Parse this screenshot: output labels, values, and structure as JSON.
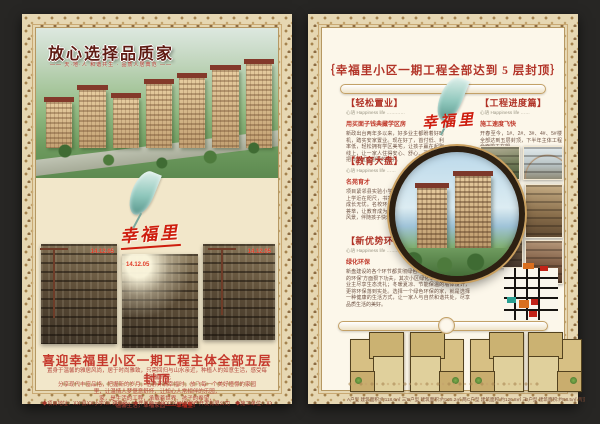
{
  "page_left": {
    "title": "放心选择品质家",
    "subtitle": "—— 天·地·人 和谐共生 · 品质人居典范 ——",
    "brand_script": "幸福里",
    "photos": [
      {
        "date": "14.12.05"
      },
      {
        "date": "14.12.05"
      },
      {
        "date": "14.12.05"
      }
    ],
    "headline": "喜迎幸福里小区一期工程主体全部五层封顶",
    "poem_lines": [
      "置身于温馨的雅居风尚，居于时尚雅致，只需回归与山水亲近，种植人的如意生活，感受每个温馨时光",
      "分享现代丰富品格，把握新的岁月，恬静开满幸福时，放飞每一个美好憧憬的家园",
      "里，让温情人梦惬意舒怀，让知心人常相伴的乐园，",
      "家，是生活的工程，承载着世界、孩子的希望，",
      "温馨生活，幸福家园"
    ],
    "poem_suffix": "——幸福里！",
    "footer": "◆项目地址：XX 县XX小学XX 路口处　◆开发商：XXXXXXX房地产开发有限公司　◆施工单位：XXXXXXXX建设有限公司"
  },
  "page_right": {
    "title": "｛幸福里小区一期工程全部达到 5 层封顶｝",
    "brand_script": "幸福里",
    "sections": [
      {
        "heading": "【轻松置业】",
        "subheading": "心语 Happiness life …………",
        "lead": "用买面子钱典藏学区房",
        "body": "新政出台两年多以来，好多业主都盼着好时机，踏实安家置业。现在好了，首付低、利率低，轻松拥有学区美宅，让孩子赢在起跑线上，让一家人住得安心、舒心、更放心，把日子过成想要的样子。"
      },
      {
        "heading": "【教育大盘】",
        "subheading": "心语 Happiness life ……",
        "lead": "名苑育才",
        "body": "项目紧邻县实验小学，孩子上学近在咫尺，书香浸润，成长无忧。名校环伺，人文荟萃，让教育成为家门口的风景，伴随孩子快乐长大。"
      },
      {
        "heading": "【新优势环保住宅】",
        "subheading": "心语 Happiness life ………",
        "lead": "绿化环保",
        "body": "新盘建设的各个环节都贯彻绿色环保理念，首先在“建材的环保”方面狠下功夫，其次小区绿化率高，自然氧吧让业主尽享生态洗礼；冬暖夏凉、节能保温的墙体设计，更将环保落到实处。选择一个绿色环保的家，就是选择一种健康的生活方式，让一家人与自然和谐共处，尽享品质生活的美好。"
      },
      {
        "heading": "【工程进度篇】",
        "subheading": "心语 Happiness life ……",
        "lead": "施工速度飞快",
        "body": "开春至今，1#、2#、3#、4#、5#楼全部达到五层封顶，下半年主体工程全面竣工在望。"
      }
    ],
    "floor_plans": [
      {
        "caption": "A户型 建筑面积:约118.6㎡ 三室两厅一卫"
      },
      {
        "caption": "B户型 建筑面积:约105.2㎡ 两室两厅一卫"
      },
      {
        "caption": "C户型 建筑面积:约126.8㎡ 三室两厅两卫"
      },
      {
        "caption": "D户型 建筑面积:约98.5㎡ 两室两厅一卫"
      }
    ]
  }
}
